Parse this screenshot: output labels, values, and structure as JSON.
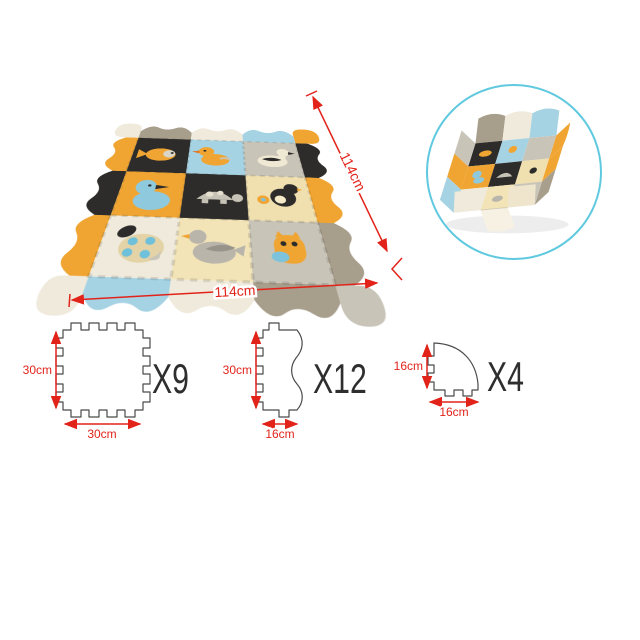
{
  "product": {
    "type": "baby foam puzzle play mat with fence",
    "views": [
      "assembled flat mat with wavy border",
      "circular inset of mat folded into playpen",
      "piece schematics with dimensions"
    ]
  },
  "palette": {
    "yellow": "#F0A533",
    "black": "#2D2C2A",
    "blue": "#A6D3E3",
    "duck_blue": "#8FC9DD",
    "cream": "#EFEADB",
    "beige": "#F0DFAF",
    "pale_beige": "#F3E4B8",
    "grey": "#C8C4B8",
    "taupe": "#A89E8C",
    "red": "#E2231A",
    "inset_ring": "#5FC9DF",
    "outline_grey": "#4a4a4a",
    "count_text": "#2e2e2e"
  },
  "mat": {
    "height_label": "114cm",
    "width_label": "114cm",
    "tiles": [
      {
        "animal": "fish",
        "color": "#2D2C2A"
      },
      {
        "animal": "duckling",
        "color": "#A6D3E3"
      },
      {
        "animal": "goose",
        "color": "#C8C4B8"
      },
      {
        "animal": "duck",
        "color": "#F0A533"
      },
      {
        "animal": "turtle",
        "color": "#2D2C2A"
      },
      {
        "animal": "chick",
        "color": "#F0DFAF"
      },
      {
        "animal": "ladybug",
        "color": "#EFEADB"
      },
      {
        "animal": "dove",
        "color": "#F3E4B8"
      },
      {
        "animal": "owl",
        "color": "#C8C4B8"
      }
    ],
    "border_colors": {
      "corner_tl": "#EFEADB",
      "top": [
        "#A89E8C",
        "#EFEADB",
        "#A6D3E3"
      ],
      "corner_tr": "#F0A533",
      "right": [
        "#2D2C2A",
        "#F0A533",
        "#A89E8C"
      ],
      "corner_br": "#C8C4B8",
      "bottom": [
        "#A6D3E3",
        "#EFEADB",
        "#A89E8C"
      ],
      "corner_bl": "#EFEADB",
      "left": [
        "#F0A533",
        "#2D2C2A",
        "#F0A533"
      ]
    }
  },
  "inset": {
    "shape": "circle",
    "shows": "mat assembled as fenced playpen with front opening"
  },
  "pieces": [
    {
      "name": "square-center-tile",
      "height_label": "30cm",
      "width_label": "30cm",
      "count_label": "X9"
    },
    {
      "name": "wavy-edge-tile",
      "height_label": "30cm",
      "width_label": "16cm",
      "count_label": "X12"
    },
    {
      "name": "rounded-corner-tile",
      "height_label": "16cm",
      "width_label": "16cm",
      "count_label": "X4"
    }
  ]
}
